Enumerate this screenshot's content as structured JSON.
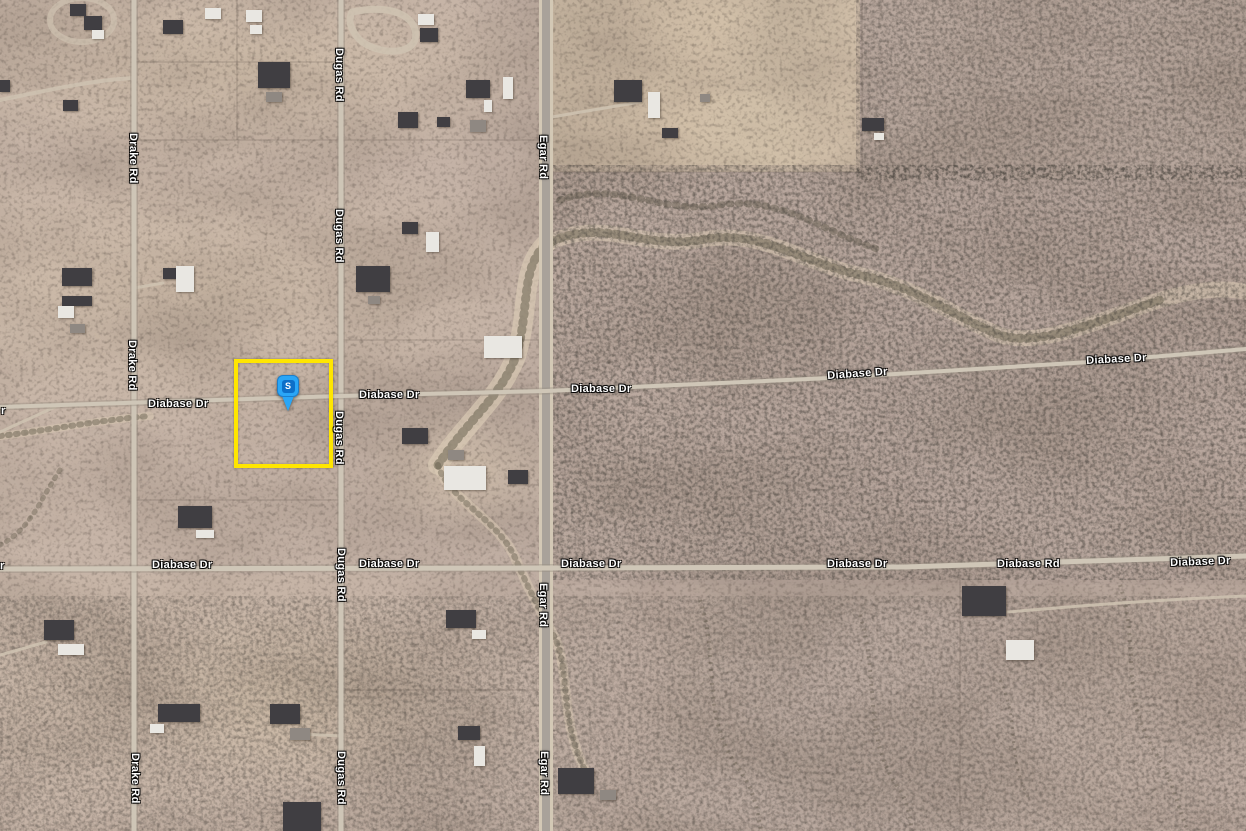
{
  "map": {
    "marker": {
      "letter": "S",
      "tip_x": 288,
      "tip_y": 411,
      "head_color": "#2aa6f7",
      "inner_color": "#0d6fc8",
      "letter_color": "#ffffff"
    },
    "selection_box": {
      "x": 234,
      "y": 359,
      "w": 99,
      "h": 109,
      "color": "#ffe600"
    },
    "label_style": {
      "color": "#ffffff",
      "halo": "#000000"
    },
    "road_labels": [
      {
        "t": "Drake Rd",
        "x": 127,
        "y": 133,
        "o": "v"
      },
      {
        "t": "Drake Rd",
        "x": 126,
        "y": 340,
        "o": "v"
      },
      {
        "t": "Drake Rd",
        "x": 129,
        "y": 753,
        "o": "v"
      },
      {
        "t": "Dugas Rd",
        "x": 333,
        "y": 48,
        "o": "v"
      },
      {
        "t": "Dugas Rd",
        "x": 333,
        "y": 209,
        "o": "v"
      },
      {
        "t": "Dugas Rd",
        "x": 333,
        "y": 411,
        "o": "v"
      },
      {
        "t": "Dugas Rd",
        "x": 335,
        "y": 548,
        "o": "v"
      },
      {
        "t": "Dugas Rd",
        "x": 335,
        "y": 751,
        "o": "v"
      },
      {
        "t": "Egar Rd",
        "x": 537,
        "y": 135,
        "o": "v"
      },
      {
        "t": "Egar Rd",
        "x": 537,
        "y": 583,
        "o": "v"
      },
      {
        "t": "Egar Rd",
        "x": 538,
        "y": 751,
        "o": "v"
      },
      {
        "t": "Diabase Dr",
        "x": 148,
        "y": 399,
        "o": "h",
        "r": 0
      },
      {
        "t": "Diabase Dr",
        "x": 359,
        "y": 390,
        "o": "h",
        "r": 0
      },
      {
        "t": "Diabase Dr",
        "x": 571,
        "y": 384,
        "o": "h",
        "r": 0
      },
      {
        "t": "Diabase Dr",
        "x": 827,
        "y": 371,
        "o": "h",
        "r": -4
      },
      {
        "t": "Diabase Dr",
        "x": 1086,
        "y": 356,
        "o": "h",
        "r": -3
      },
      {
        "t": "Diabase Dr",
        "x": 152,
        "y": 560,
        "o": "h",
        "r": 0
      },
      {
        "t": "Diabase Dr",
        "x": 359,
        "y": 559,
        "o": "h",
        "r": 0
      },
      {
        "t": "Diabase Dr",
        "x": 561,
        "y": 559,
        "o": "h",
        "r": 0
      },
      {
        "t": "Diabase Dr",
        "x": 827,
        "y": 559,
        "o": "h",
        "r": 0
      },
      {
        "t": "Diabase Rd",
        "x": 997,
        "y": 559,
        "o": "h",
        "r": 0
      },
      {
        "t": "Diabase Dr",
        "x": 1170,
        "y": 558,
        "o": "h",
        "r": -2
      },
      {
        "t": "r",
        "x": 1,
        "y": 406,
        "o": "h",
        "r": 0
      },
      {
        "t": "r",
        "x": 0,
        "y": 561,
        "o": "h",
        "r": 0
      }
    ],
    "roads": {
      "vertical": [
        {
          "name": "Drake Rd",
          "x": 134,
          "w": 5,
          "color": "#cec5b6",
          "casing": "rgba(150,140,128,0.45)",
          "casing_w": 8
        },
        {
          "name": "Dugas Rd",
          "x": 341,
          "w": 5,
          "color": "#cec5b6",
          "casing": "rgba(150,140,128,0.45)",
          "casing_w": 8
        },
        {
          "name": "Egar Rd",
          "x": 546,
          "w": 8,
          "color": "#a9a29a",
          "casing": "#d3c8b5",
          "casing_w": 14
        }
      ],
      "horizontal": [
        {
          "name": "Diabase Dr",
          "points": "0,407 341,396 546,391 830,378 1090,362 1246,349",
          "w": 4,
          "color": "#cfc6b7",
          "casing": "rgba(150,140,128,0.4)",
          "casing_w": 7
        },
        {
          "name": "Diabase Dr / Diabase Rd",
          "points": "0,569 546,568 905,567 1246,556",
          "w": 5,
          "color": "#cfc6b7",
          "casing": "rgba(150,140,128,0.4)",
          "casing_w": 8
        }
      ]
    },
    "buildings": [
      [
        70,
        4,
        16,
        12,
        "dark"
      ],
      [
        84,
        16,
        18,
        14,
        "dark"
      ],
      [
        92,
        30,
        12,
        9,
        "white"
      ],
      [
        163,
        20,
        20,
        14,
        "dark"
      ],
      [
        205,
        8,
        16,
        11,
        "white"
      ],
      [
        246,
        10,
        16,
        12,
        "white"
      ],
      [
        250,
        25,
        12,
        9,
        "white"
      ],
      [
        258,
        62,
        32,
        26,
        "dark"
      ],
      [
        266,
        92,
        16,
        10,
        "gray"
      ],
      [
        0,
        80,
        10,
        12,
        "dark"
      ],
      [
        63,
        100,
        15,
        11,
        "dark"
      ],
      [
        418,
        14,
        16,
        11,
        "white"
      ],
      [
        420,
        28,
        18,
        14,
        "dark"
      ],
      [
        398,
        112,
        20,
        16,
        "dark"
      ],
      [
        437,
        117,
        13,
        10,
        "dark"
      ],
      [
        466,
        80,
        24,
        18,
        "dark"
      ],
      [
        503,
        77,
        10,
        22,
        "white"
      ],
      [
        484,
        100,
        8,
        12,
        "white"
      ],
      [
        470,
        120,
        16,
        12,
        "gray"
      ],
      [
        614,
        80,
        28,
        22,
        "dark"
      ],
      [
        648,
        92,
        12,
        26,
        "white"
      ],
      [
        662,
        128,
        16,
        10,
        "dark"
      ],
      [
        700,
        94,
        10,
        8,
        "gray"
      ],
      [
        862,
        118,
        22,
        13,
        "dark"
      ],
      [
        874,
        133,
        10,
        7,
        "white"
      ],
      [
        402,
        222,
        16,
        12,
        "dark"
      ],
      [
        426,
        232,
        13,
        20,
        "white"
      ],
      [
        62,
        268,
        30,
        18,
        "dark"
      ],
      [
        62,
        296,
        30,
        10,
        "dark"
      ],
      [
        58,
        306,
        16,
        12,
        "white"
      ],
      [
        70,
        324,
        15,
        9,
        "gray"
      ],
      [
        163,
        268,
        14,
        11,
        "dark"
      ],
      [
        176,
        266,
        18,
        26,
        "white"
      ],
      [
        356,
        266,
        34,
        26,
        "dark"
      ],
      [
        368,
        296,
        12,
        8,
        "gray"
      ],
      [
        484,
        336,
        38,
        22,
        "white"
      ],
      [
        402,
        428,
        26,
        16,
        "dark"
      ],
      [
        448,
        450,
        16,
        10,
        "gray"
      ],
      [
        444,
        466,
        42,
        24,
        "white"
      ],
      [
        508,
        470,
        20,
        14,
        "dark"
      ],
      [
        178,
        506,
        34,
        22,
        "dark"
      ],
      [
        196,
        530,
        18,
        8,
        "white"
      ],
      [
        44,
        620,
        30,
        20,
        "dark"
      ],
      [
        58,
        644,
        26,
        11,
        "white"
      ],
      [
        158,
        704,
        42,
        18,
        "dark"
      ],
      [
        150,
        724,
        14,
        9,
        "white"
      ],
      [
        270,
        704,
        30,
        20,
        "dark"
      ],
      [
        290,
        728,
        20,
        12,
        "gray"
      ],
      [
        283,
        802,
        38,
        29,
        "dark"
      ],
      [
        446,
        610,
        30,
        18,
        "dark"
      ],
      [
        472,
        630,
        14,
        9,
        "white"
      ],
      [
        458,
        726,
        22,
        14,
        "dark"
      ],
      [
        474,
        746,
        11,
        20,
        "white"
      ],
      [
        558,
        768,
        36,
        26,
        "dark"
      ],
      [
        600,
        790,
        16,
        10,
        "gray"
      ],
      [
        962,
        586,
        44,
        30,
        "dark"
      ],
      [
        1006,
        640,
        28,
        20,
        "white"
      ]
    ]
  }
}
